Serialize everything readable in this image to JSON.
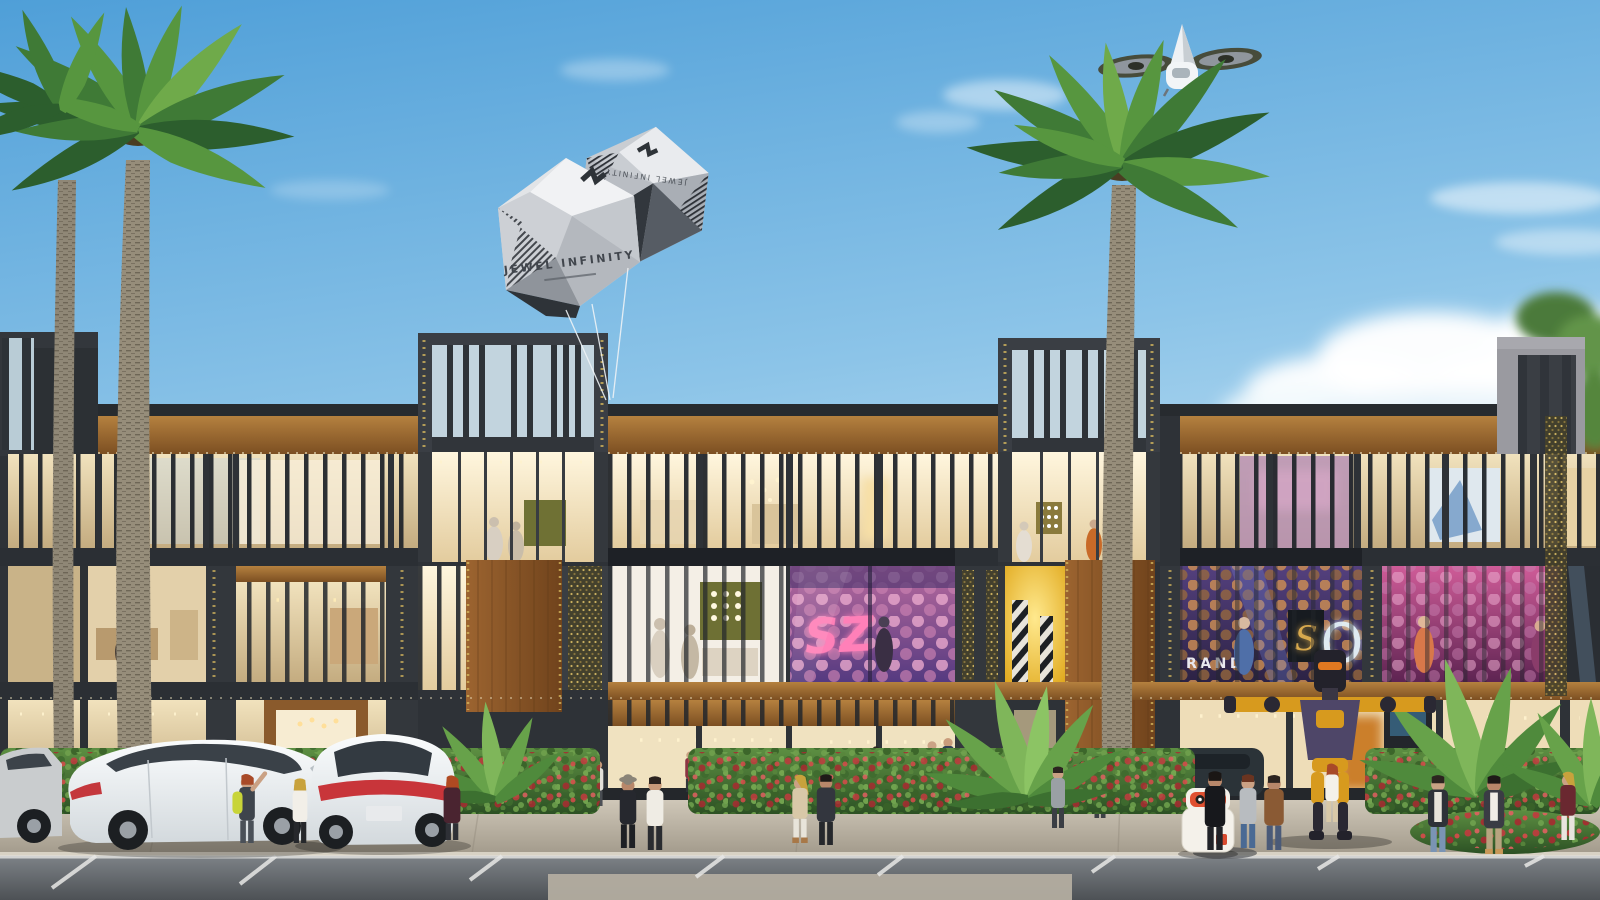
{
  "scene": {
    "type": "architectural-rendering",
    "description": "Daytime photorealistic rendering of a modern 3-storey retail boulevard with charcoal frames, wood soffits, glass storefronts and vertical fin screens; palm trees, flower hedges, angled street parking, pedestrians, a humanoid robot, a delivery robot, gem-shaped advertising balloons and a passenger air taxi in a blue sky with clouds",
    "texts": {
      "balloon_brand": "JEWEL INFINITY",
      "balloon_brand_mirrored": "JEWEL INFINITY",
      "store_brand_partial": "RAND",
      "store_letter_s": "S",
      "store_neon_o": "O",
      "store_neon_sz": "SZ"
    },
    "objects": {
      "air_taxi": "white twin-rotor passenger drone",
      "balloons": "2 faceted gem-shaped tethered balloons",
      "humanoid_robot": "yellow and purple robot with arms outstretched",
      "delivery_robot": "small white robot with red face plate",
      "parked_cars": "white sedans in angled parking, partial grey car, SUVs behind hedge",
      "palm_trees": "2 tall date palms plus fan-palm shrubs",
      "pedestrians": "about 20 people strolling the sidewalk"
    },
    "colors": {
      "sky_top": "#4f9fd8",
      "sky_horizon": "#dff0f9",
      "facade_charcoal": "#33373c",
      "wood": "#a5713a",
      "glass_warm": "#eed9ae",
      "hedge_green": "#4a7a36",
      "flower_red": "#c23a3e",
      "road_grey": "#6f757a",
      "neon_pink": "#ff80b8",
      "store_yellow": "#f2c437",
      "store_purple": "#4a3570",
      "robot_yellow": "#d79a1e",
      "robot_purple": "#4e4668",
      "balloon_grey": "#d9dce0"
    }
  }
}
